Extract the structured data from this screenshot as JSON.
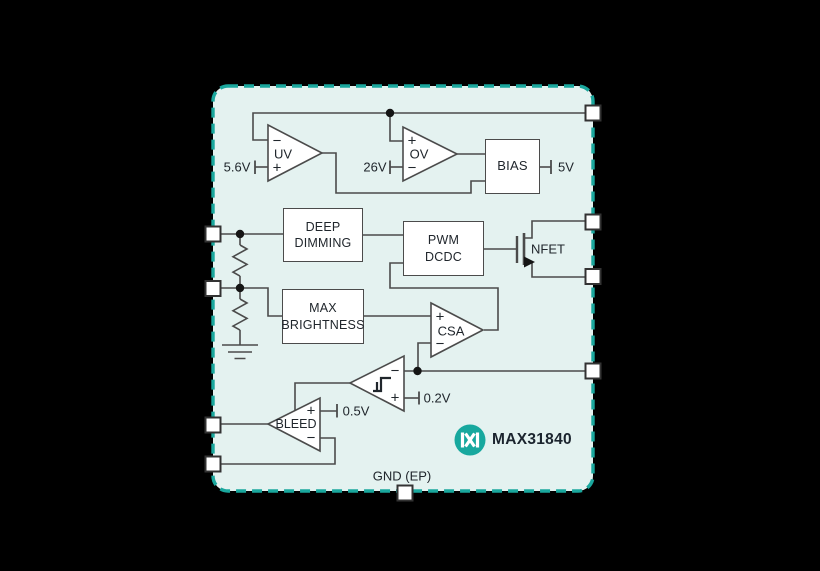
{
  "colors": {
    "background": "#000000",
    "chip_fill": "#e4f2f0",
    "chip_border": "#1aa79d",
    "wire": "#4b4b4b",
    "logo_teal": "#17a89e",
    "text": "#20262c"
  },
  "chip": {
    "part_number": "MAX31840",
    "logo_icon": "maxim-logo",
    "ground_pin_label": "GND (EP)"
  },
  "blocks": {
    "deep_dimming": {
      "line1": "DEEP",
      "line2": "DIMMING"
    },
    "pwm_dcdc": {
      "line1": "PWM",
      "line2": "DCDC"
    },
    "max_brightness": {
      "line1": "MAX",
      "line2": "BRIGHTNESS"
    },
    "bias": {
      "label": "BIAS",
      "output_ref": "5V"
    }
  },
  "amplifiers": {
    "uv": {
      "label": "UV",
      "top_sign": "−",
      "bottom_sign": "+",
      "ref": "5.6V"
    },
    "ov": {
      "label": "OV",
      "top_sign": "+",
      "bottom_sign": "−",
      "ref": "26V"
    },
    "csa": {
      "label": "CSA",
      "top_sign": "+",
      "bottom_sign": "−"
    },
    "hysteresis_comparator": {
      "top_sign": "−",
      "bottom_sign": "+",
      "ref": "0.2V"
    },
    "bleed": {
      "label": "BLEED",
      "top_sign": "+",
      "bottom_sign": "−",
      "ref": "0.5V"
    }
  },
  "transistor": {
    "label": "NFET"
  }
}
